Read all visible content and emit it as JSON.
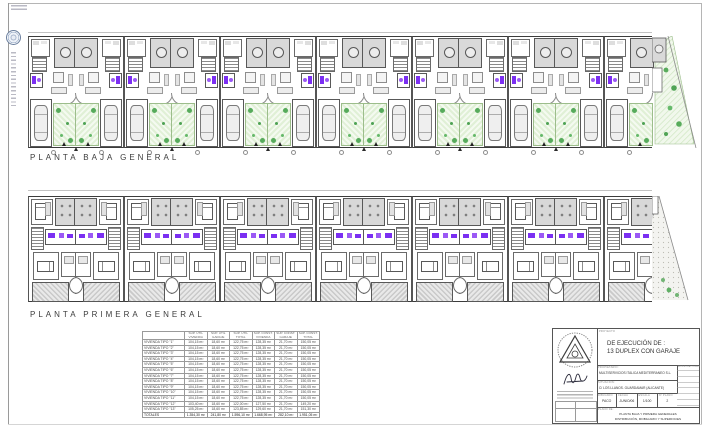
{
  "plans": {
    "baja": {
      "label": "PLANTA BAJA GENERAL",
      "units": 13,
      "dimension": "104,90"
    },
    "primera": {
      "label": "PLANTA PRIMERA GENERAL",
      "units": 13,
      "dimension": "104,90"
    }
  },
  "areas_table": {
    "columns": [
      [
        "",
        ""
      ],
      [
        "SUP. ÚTIL",
        "VIVIENDA"
      ],
      [
        "SUP. ÚTIL",
        "GARAJE"
      ],
      [
        "SUP. ÚTIL",
        "TOTAL"
      ],
      [
        "SUP. CONST.",
        "VIVIENDA"
      ],
      [
        "SUP. CONST.",
        "GARAJE"
      ],
      [
        "SUP. CONST.",
        "TOTAL"
      ]
    ],
    "rows": [
      [
        "VIVIENDA TIPO \"1\"",
        "104,15 m²",
        "18,60 m²",
        "122,75 m²",
        "128,35 m²",
        "21,70 m²",
        "150,05 m²"
      ],
      [
        "VIVIENDA TIPO \"2\"",
        "104,15 m²",
        "18,60 m²",
        "122,75 m²",
        "128,35 m²",
        "21,70 m²",
        "150,05 m²"
      ],
      [
        "VIVIENDA TIPO \"3\"",
        "104,15 m²",
        "18,60 m²",
        "122,75 m²",
        "128,35 m²",
        "21,70 m²",
        "150,05 m²"
      ],
      [
        "VIVIENDA TIPO \"4\"",
        "104,15 m²",
        "18,60 m²",
        "122,75 m²",
        "128,35 m²",
        "21,70 m²",
        "150,05 m²"
      ],
      [
        "VIVIENDA TIPO \"5\"",
        "104,15 m²",
        "18,60 m²",
        "122,75 m²",
        "128,35 m²",
        "21,70 m²",
        "150,05 m²"
      ],
      [
        "VIVIENDA TIPO \"6\"",
        "104,15 m²",
        "18,60 m²",
        "122,75 m²",
        "128,35 m²",
        "21,70 m²",
        "150,05 m²"
      ],
      [
        "VIVIENDA TIPO \"7\"",
        "104,15 m²",
        "18,60 m²",
        "122,75 m²",
        "128,35 m²",
        "21,70 m²",
        "150,05 m²"
      ],
      [
        "VIVIENDA TIPO \"8\"",
        "104,15 m²",
        "18,60 m²",
        "122,75 m²",
        "128,35 m²",
        "21,70 m²",
        "150,05 m²"
      ],
      [
        "VIVIENDA TIPO \"9\"",
        "104,15 m²",
        "18,60 m²",
        "122,75 m²",
        "128,35 m²",
        "21,70 m²",
        "150,05 m²"
      ],
      [
        "VIVIENDA TIPO \"10\"",
        "104,15 m²",
        "18,60 m²",
        "122,75 m²",
        "128,35 m²",
        "21,70 m²",
        "150,05 m²"
      ],
      [
        "VIVIENDA TIPO \"11\"",
        "104,15 m²",
        "18,60 m²",
        "122,75 m²",
        "128,35 m²",
        "21,70 m²",
        "150,05 m²"
      ],
      [
        "VIVIENDA TIPO \"12\"",
        "103,40 m²",
        "18,60 m²",
        "122,00 m²",
        "127,50 m²",
        "21,70 m²",
        "149,20 m²"
      ],
      [
        "VIVIENDA TIPO \"13\"",
        "105,25 m²",
        "18,60 m²",
        "123,85 m²",
        "129,60 m²",
        "21,70 m²",
        "151,30 m²"
      ]
    ],
    "totals": [
      "TOTALES",
      "1.354,30 m²",
      "241,80 m²",
      "1.596,10 m²",
      "1.668,95 m²",
      "282,10 m²",
      "1.951,05 m²"
    ]
  },
  "title_block": {
    "project_label": "PROYECTO",
    "project_line1": "DE EJECUCIÓN DE :",
    "project_line2": "13 DUPLEX CON GARAJE",
    "owner_label": "PROPIETARIO:",
    "owner": "MULTISERVICIOS ITALICA MEDITERRANEO S.L.",
    "site_label": "SITUACIÓN:",
    "site": "C/ LOS LLANOS. GUARDAMAR (ALICANTE)",
    "revisions_label": "MODIFICACIONES",
    "fields": [
      {
        "label": "DIBUJADO",
        "value": "PACO"
      },
      {
        "label": "FECHA",
        "value": "JUNIO/06"
      },
      {
        "label": "ESCALA",
        "value": "1/100"
      },
      {
        "label": "Nº PLANO",
        "value": "2"
      }
    ],
    "sheet_label": "PLANO DE:",
    "sheet_line1": "PLANTA BAJA Y PRIMERA GENERALES",
    "sheet_line2": "DISTRIBUCIÓN, MOBILIARIO Y SUPERFICIES"
  },
  "colors": {
    "bathroom_accent": "#7b2ff2",
    "garden_green": "#47a34d",
    "patio_gray": "#d9d9d9",
    "wall": "#4a4a4a"
  }
}
